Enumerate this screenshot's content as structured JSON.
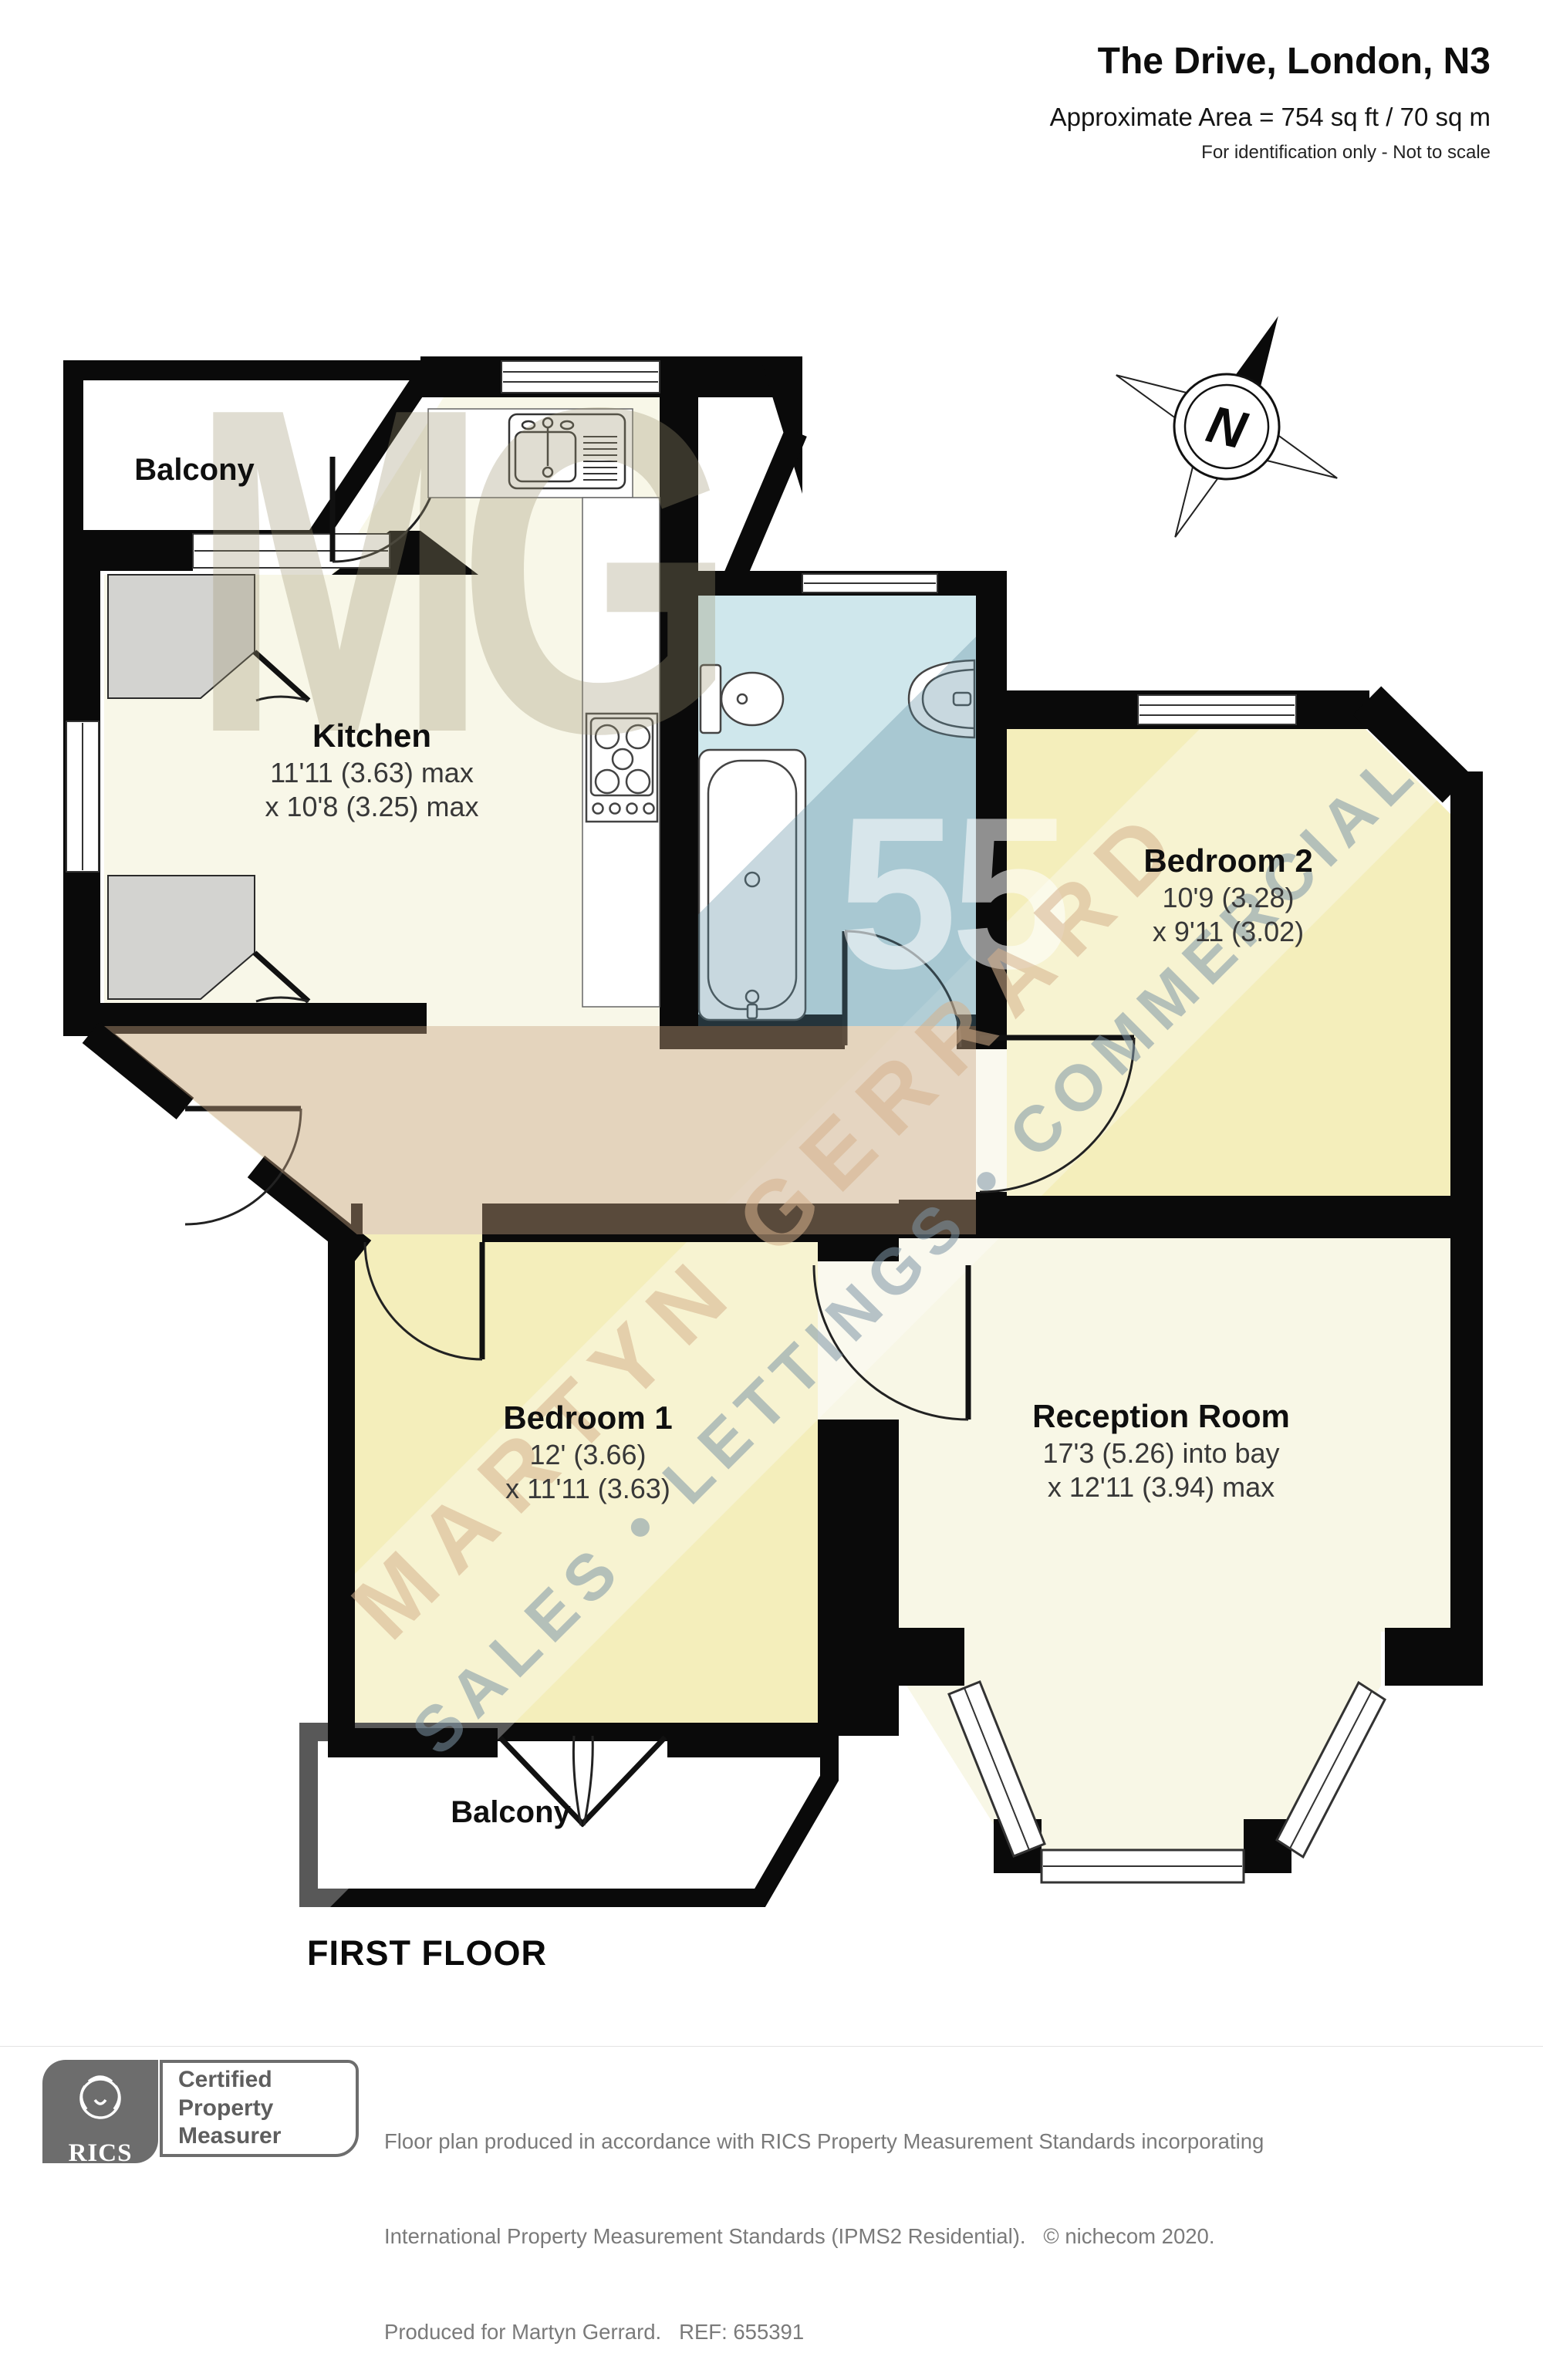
{
  "header": {
    "title": "The Drive, London, N3",
    "area": "Approximate Area = 754 sq ft / 70 sq m",
    "note": "For identification only - Not to scale"
  },
  "compass": {
    "label": "N"
  },
  "plan": {
    "floor_label": "FIRST FLOOR"
  },
  "rooms": {
    "balcony_top": {
      "name": "Balcony"
    },
    "kitchen": {
      "name": "Kitchen",
      "dim1": "11'11 (3.63) max",
      "dim2": "x 10'8 (3.25) max"
    },
    "bedroom2": {
      "name": "Bedroom 2",
      "dim1": "10'9 (3.28)",
      "dim2": "x 9'11 (3.02)"
    },
    "bedroom1": {
      "name": "Bedroom 1",
      "dim1": "12' (3.66)",
      "dim2": "x 11'11 (3.63)"
    },
    "reception": {
      "name": "Reception Room",
      "dim1": "17'3 (5.26) into bay",
      "dim2": "x 12'11 (3.94) max"
    },
    "balcony_bottom": {
      "name": "Balcony"
    }
  },
  "watermark": {
    "monogram": "MG",
    "number": "55",
    "line1": "MARTYN GERRARD",
    "line2": "SALES • LETTINGS • COMMERCIAL"
  },
  "footer": {
    "rics": "RICS",
    "badge": {
      "line1": "Certified",
      "line2": "Property",
      "line3": "Measurer"
    },
    "lines": [
      "Floor plan produced in accordance with RICS Property Measurement Standards incorporating",
      "International Property Measurement Standards (IPMS2 Residential).   © nichecom 2020.",
      "Produced for Martyn Gerrard.   REF: 655391"
    ]
  },
  "colors": {
    "walls": "#0a0a0a",
    "kitchen": "#f8f7e8",
    "hall": "#f8f7e8",
    "bathroom": "#cfe7ec",
    "bedroom": "#f4eebb",
    "reception": "#f8f7e6",
    "balcony": "#ffffff",
    "closet": "#d3d3d0"
  }
}
